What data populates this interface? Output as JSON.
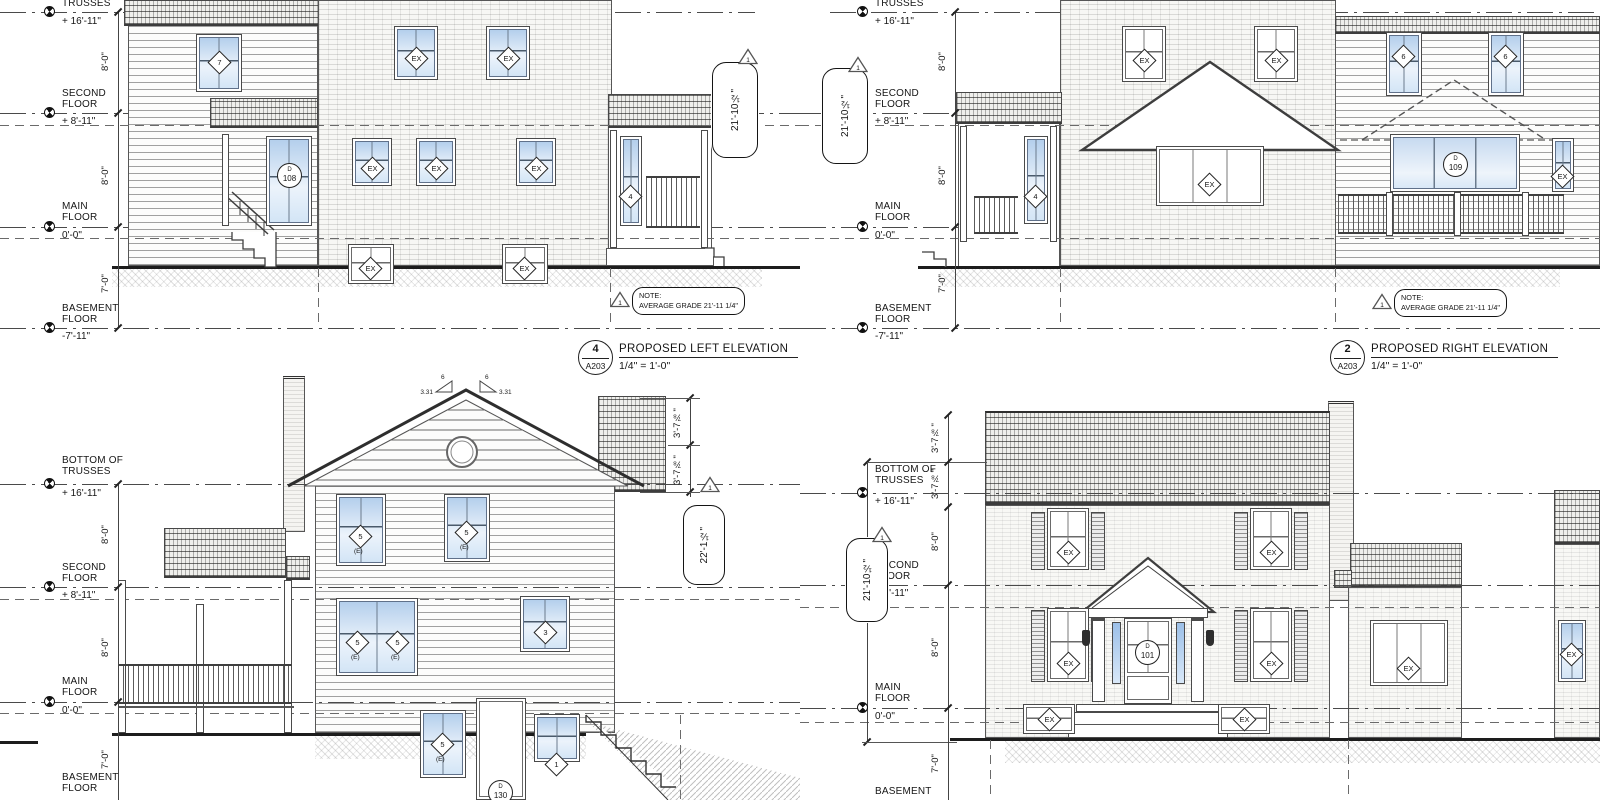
{
  "drawing": {
    "note_prefix": "NOTE:",
    "note_text": "AVERAGE GRADE 21'-11 1/4\"",
    "rev": "1",
    "avg_grade_height": "21'-10½\"",
    "rear_height": "22'-1½\"",
    "slope_rise": "3.31",
    "slope_run": "6"
  },
  "levels": {
    "bottom_of_trusses": "BOTTOM OF TRUSSES",
    "trusses": "TRUSSES",
    "second": "SECOND FLOOR",
    "main": "MAIN FLOOR",
    "basement_floor": "BASEMENT FLOOR",
    "basement": "BASEMENT",
    "v_trusses": "+ 16'-11\"",
    "v_second": "+ 8'-11\"",
    "v_main": "0'-0\"",
    "v_basement": "-7'-11\""
  },
  "dims": {
    "d8": "8'-0\"",
    "d7": "7'-0\"",
    "d378": "3'-7⅞\""
  },
  "titles": {
    "left": {
      "num": "4",
      "sheet": "A203",
      "name": "PROPOSED LEFT ELEVATION",
      "scale": "1/4\" = 1'-0\""
    },
    "right": {
      "num": "2",
      "sheet": "A203",
      "name": "PROPOSED RIGHT ELEVATION",
      "scale": "1/4\" = 1'-0\""
    }
  },
  "tags": {
    "ex": "EX",
    "e": "(E)",
    "d": "D",
    "n7": "7",
    "n4": "4",
    "n6": "6",
    "n5": "5",
    "n3": "3",
    "n1": "1",
    "d108": "108",
    "d109": "109",
    "d101": "101",
    "d130": "130"
  }
}
